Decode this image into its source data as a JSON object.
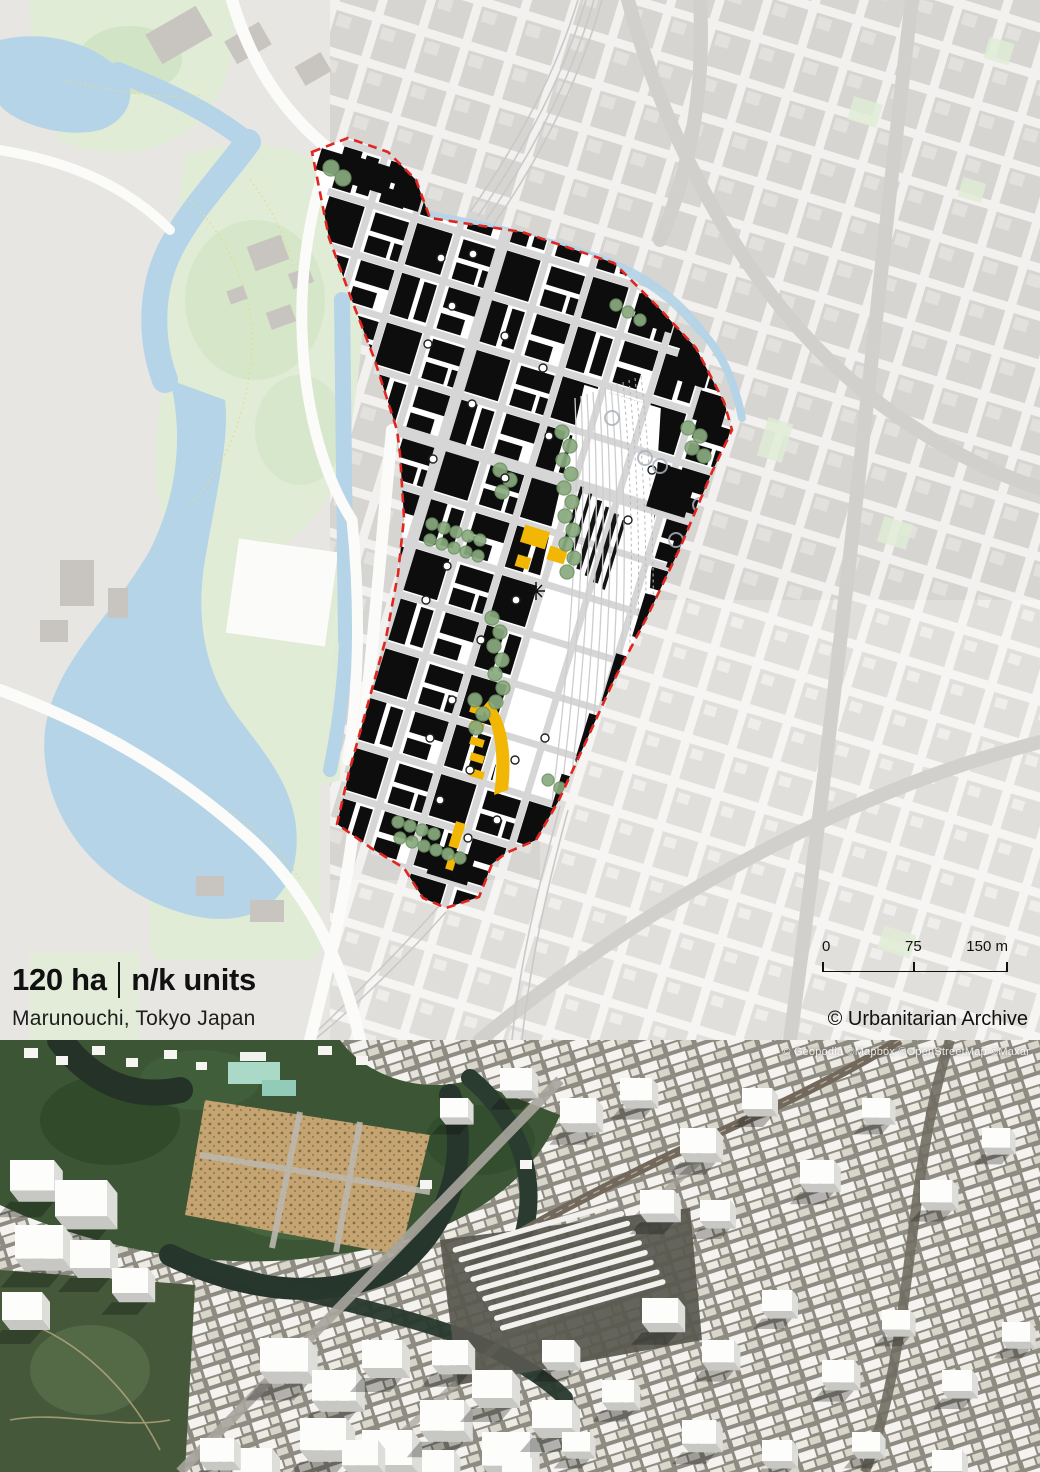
{
  "map_panel": {
    "stats": {
      "area": "120 ha",
      "units": "n/k units"
    },
    "location": "Marunouchi, Tokyo Japan",
    "scale_bar": {
      "zero": "0",
      "mid": "75",
      "end": "150 m"
    },
    "attribution": "© Urbanitarian Archive"
  },
  "satellite_panel": {
    "attribution": "© Geopodia ©Mapbox ©OpenStreetMap ©Maxar"
  },
  "colors": {
    "boundary_red": "#e1251f",
    "building_black": "#0d0d0d",
    "water_blue": "#b5d4e8",
    "park_green": "#e0ecd6",
    "tree_green": "#8aab7f",
    "accent_yellow": "#f2b705",
    "context_gray": "#d7d5d1",
    "forest_green": "#35502f",
    "plaza_tan": "#c5a26d"
  }
}
